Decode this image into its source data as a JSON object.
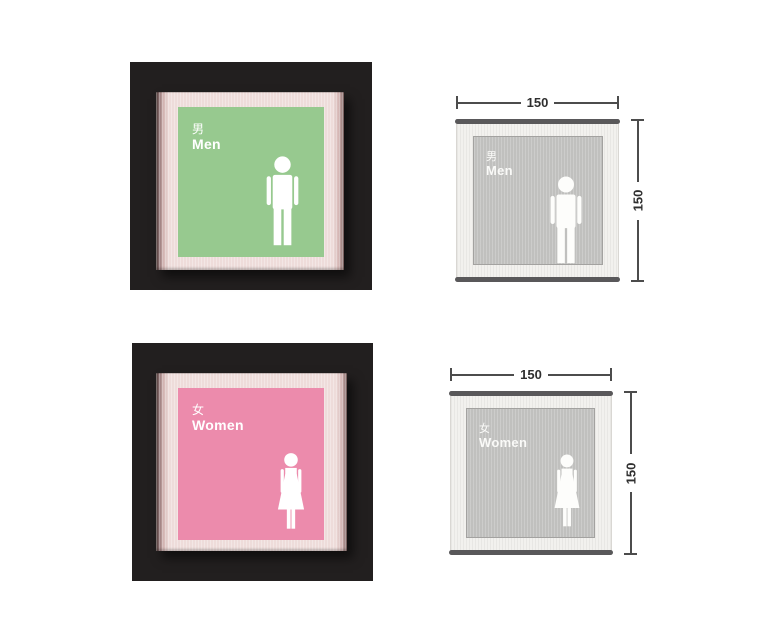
{
  "mockups": {
    "men": {
      "cjk": "男",
      "label": "Men"
    },
    "women": {
      "cjk": "女",
      "label": "Women"
    }
  },
  "drawings": {
    "men": {
      "cjk": "男",
      "label": "Men",
      "width_mm": "150",
      "height_mm": "150"
    },
    "women": {
      "cjk": "女",
      "label": "Women",
      "width_mm": "150",
      "height_mm": "150"
    }
  },
  "icons": {
    "men": "male-pictogram",
    "women": "female-pictogram"
  },
  "colors": {
    "backdrop": "#221f1f",
    "frame_pink": "#eedcda",
    "panel_green": "#97c98f",
    "panel_pink": "#ec8bac",
    "drawing_frame": "#f2f1ee",
    "drawing_panel": "#c0c0be",
    "drawing_bar": "#59585a",
    "dimension": "#4c4c4c",
    "pictogram": "#ffffff"
  }
}
